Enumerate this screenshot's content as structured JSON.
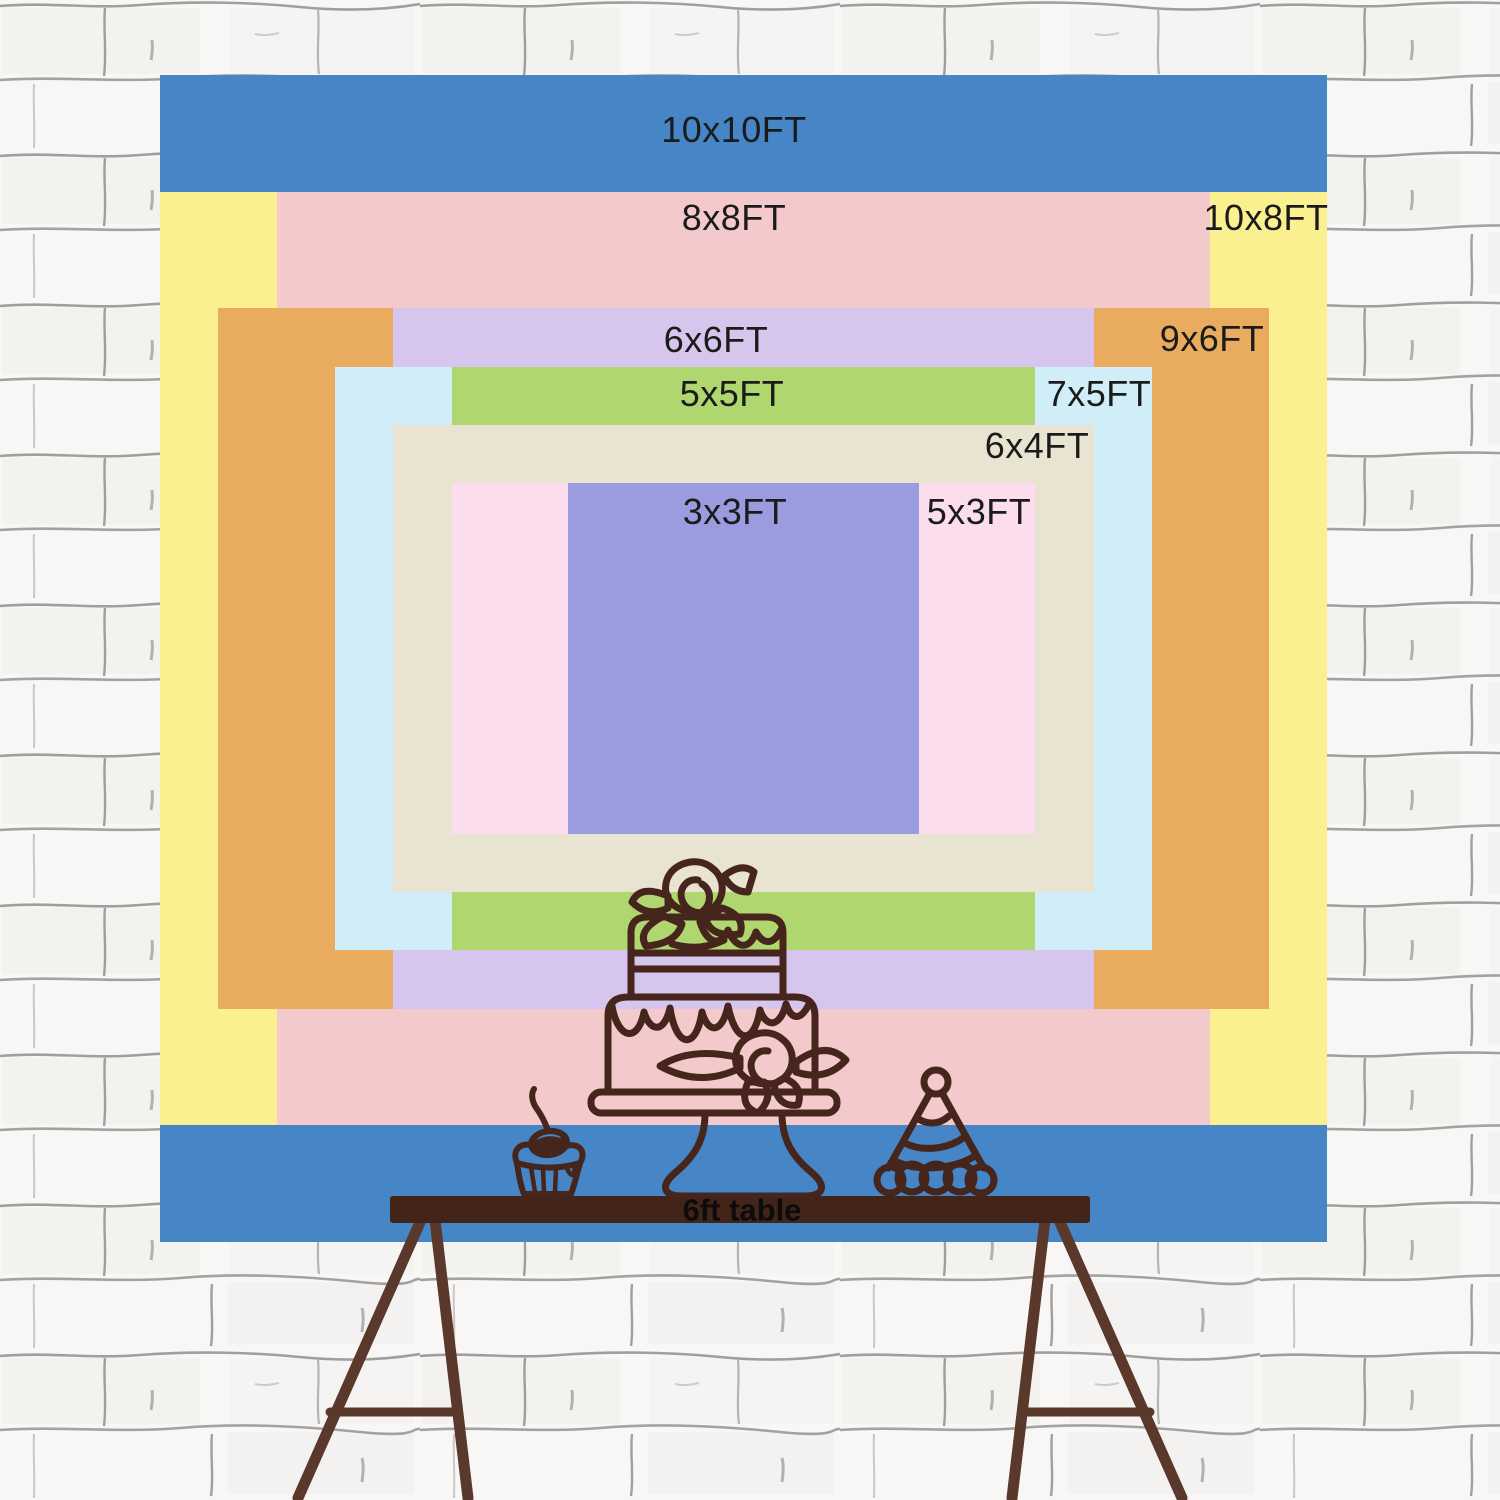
{
  "backdrop": {
    "unit": "FT",
    "px_per_ft": 116.7,
    "w_px": 1167,
    "h_px": 1167,
    "layers": [
      {
        "name": "10x10",
        "label": "10x10FT",
        "w_ft": 10,
        "h_ft": 10,
        "color": "#4686C6",
        "label_x": 734,
        "label_y": 130
      },
      {
        "name": "10x8",
        "label": "10x8FT",
        "w_ft": 10,
        "h_ft": 8,
        "color": "#FAF08F",
        "label_x": 1266,
        "label_y": 218
      },
      {
        "name": "8x8",
        "label": "8x8FT",
        "w_ft": 8,
        "h_ft": 8,
        "color": "#F4C9CB",
        "label_x": 734,
        "label_y": 218
      },
      {
        "name": "9x6",
        "label": "9x6FT",
        "w_ft": 9,
        "h_ft": 6,
        "color": "#E9AC5E",
        "label_x": 1212,
        "label_y": 339
      },
      {
        "name": "6x6",
        "label": "6x6FT",
        "w_ft": 6,
        "h_ft": 6,
        "color": "#D6C5EC",
        "label_x": 716,
        "label_y": 340
      },
      {
        "name": "7x5",
        "label": "7x5FT",
        "w_ft": 7,
        "h_ft": 5,
        "color": "#D0EDF8",
        "label_x": 1099,
        "label_y": 394
      },
      {
        "name": "5x5",
        "label": "5x5FT",
        "w_ft": 5,
        "h_ft": 5,
        "color": "#B0D66F",
        "label_x": 732,
        "label_y": 394
      },
      {
        "name": "6x4",
        "label": "6x4FT",
        "w_ft": 6,
        "h_ft": 4,
        "color": "#E9E4D2",
        "label_x": 1037,
        "label_y": 446
      },
      {
        "name": "5x3",
        "label": "5x3FT",
        "w_ft": 5,
        "h_ft": 3,
        "color": "#FCDDED",
        "label_x": 979,
        "label_y": 512
      },
      {
        "name": "3x3",
        "label": "3x3FT",
        "w_ft": 3,
        "h_ft": 3,
        "color": "#9B9BE0",
        "label_x": 735,
        "label_y": 512
      }
    ]
  },
  "table": {
    "label": "6ft table",
    "label_x": 742,
    "label_y": 1210,
    "bar_color": "#432419",
    "leg_color": "#5A382B"
  },
  "illustration": {
    "outline_color": "#45251C",
    "cherry_highlight": "#4686C6",
    "items": [
      "tiered-cake",
      "cupcake-with-cherry",
      "party-hat"
    ]
  },
  "wall": {
    "background": "#F8F7F5",
    "mortar": "#8F8F8F"
  }
}
